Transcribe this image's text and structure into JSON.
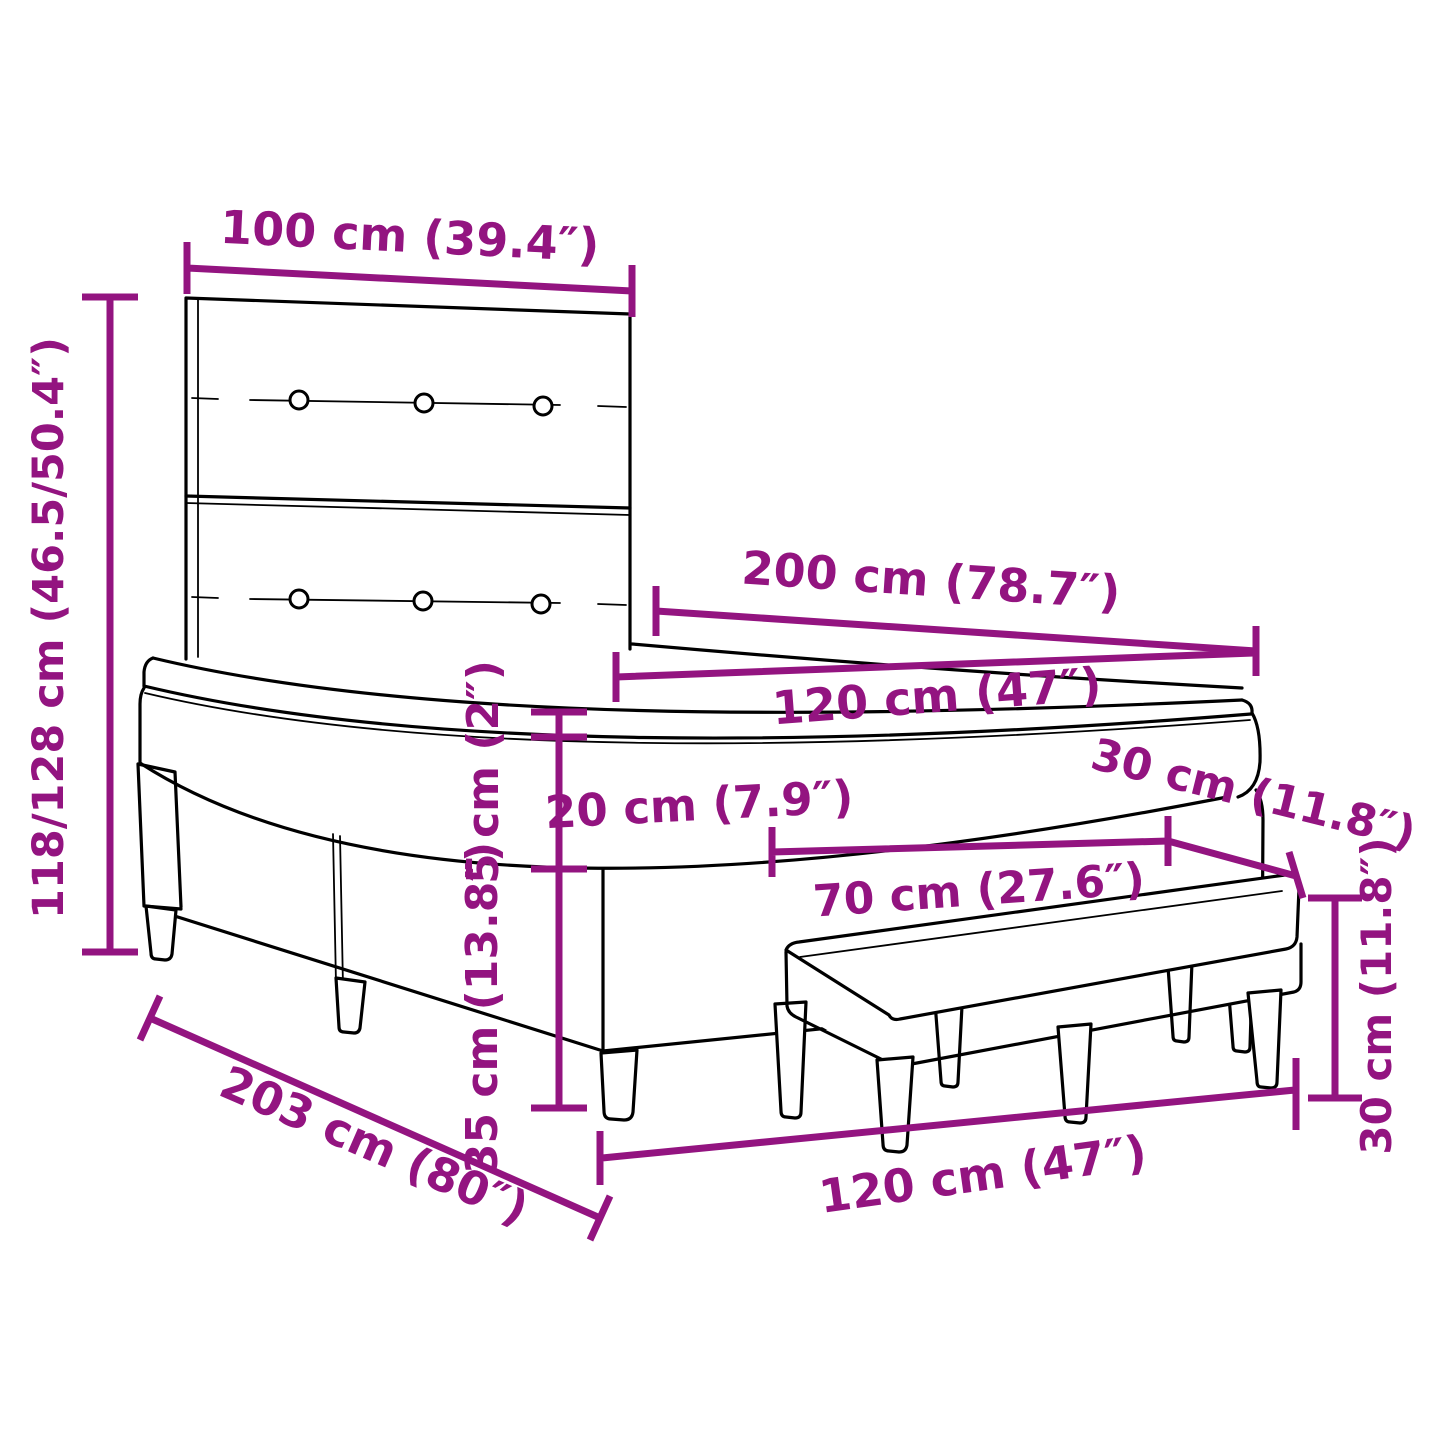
{
  "colors": {
    "dimension": "#931480",
    "artwork": "#000000",
    "background": "#ffffff"
  },
  "diagram": {
    "subject": "box-spring-bed-with-headboard-topper-and-bench",
    "dimensions": {
      "headboard_width": "100 cm (39.4″)",
      "overall_height": "118/128 cm (46.5/50.4″)",
      "mattress_length": "200 cm (78.7″)",
      "mattress_width": "120 cm (47″)",
      "topper_height": "5 cm (2″)",
      "mattress_height": "20 cm (7.9″)",
      "base_height": "35 cm (13.8″)",
      "bench_length": "70 cm (27.6″)",
      "bench_depth": "30 cm (11.8″)",
      "bench_height": "30 cm (11.8″)",
      "overall_length": "203 cm (80″)",
      "base_width": "120 cm (47″)"
    }
  }
}
